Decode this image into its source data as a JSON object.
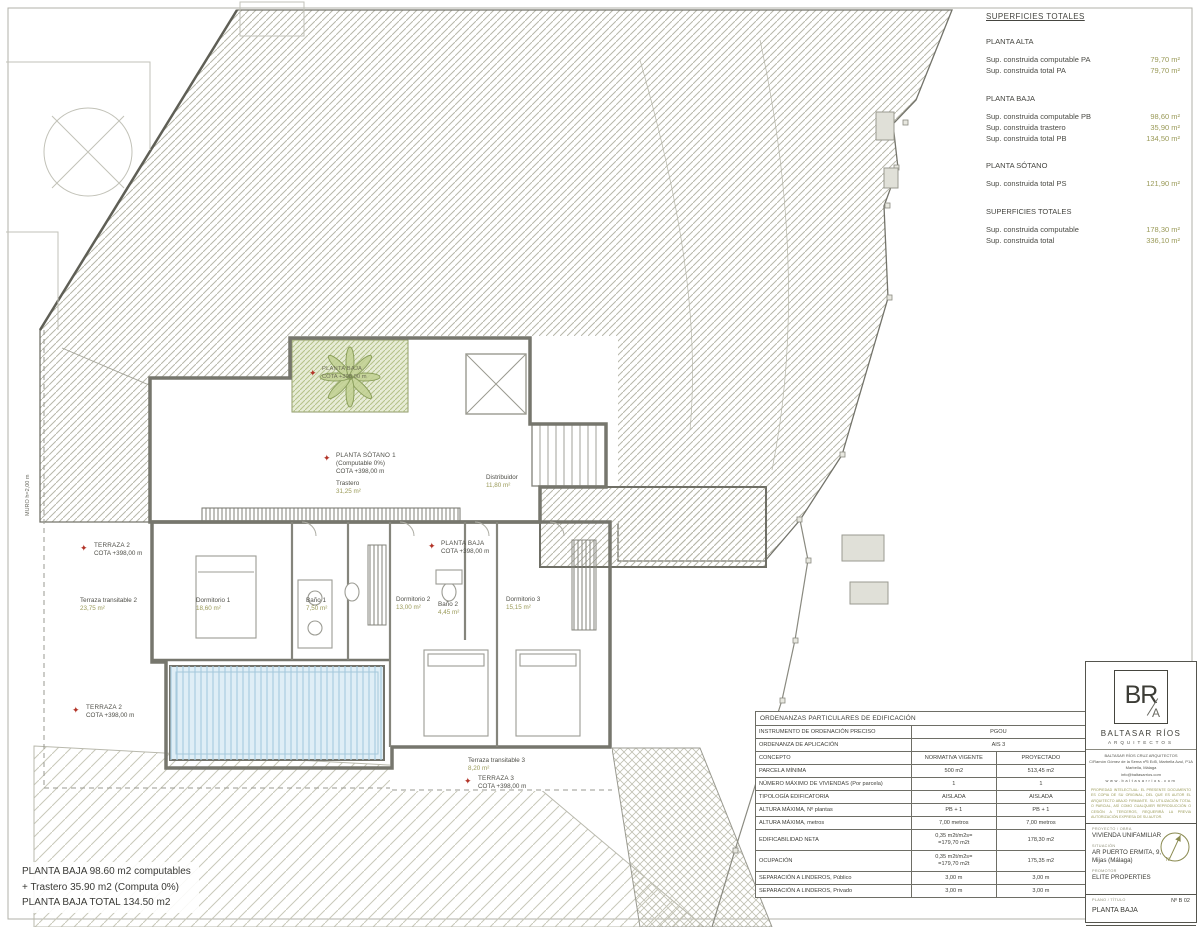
{
  "icons": {
    "star": "✦",
    "north": "N"
  },
  "superficies": {
    "title": "SUPERFICIES TOTALES",
    "sections": [
      {
        "heading": "PLANTA ALTA",
        "rows": [
          [
            "Sup. construida computable PA",
            "79,70 m²"
          ],
          [
            "Sup. construida total PA",
            "79,70 m²"
          ]
        ]
      },
      {
        "heading": "PLANTA BAJA",
        "rows": [
          [
            "Sup. construida computable PB",
            "98,60 m²"
          ],
          [
            "Sup. construida trastero",
            "35,90 m²"
          ],
          [
            "Sup. construida total PB",
            "134,50 m²"
          ]
        ]
      },
      {
        "heading": "PLANTA SÓTANO",
        "rows": [
          [
            "Sup. construida total PS",
            "121,90 m²"
          ]
        ]
      },
      {
        "heading": "SUPERFICIES TOTALES",
        "rows": [
          [
            "Sup. construida computable",
            "178,30 m²"
          ],
          [
            "Sup. construida total",
            "336,10 m²"
          ]
        ]
      }
    ]
  },
  "ordenanzas": {
    "title": "ORDENANZAS PARTICULARES DE EDIFICACIÓN",
    "instrumento_label": "INSTRUMENTO DE ORDENACIÓN PRECISO",
    "instrumento_value": "PGOU",
    "ordenanza_label": "ORDENANZA DE APLICACIÓN",
    "ordenanza_value": "AIS 3",
    "headers": [
      "CONCEPTO",
      "NORMATIVA VIGENTE",
      "PROYECTADO"
    ],
    "rows": [
      [
        "PARCELA MÍNIMA",
        "500 m2",
        "513,45 m2"
      ],
      [
        "NÚMERO MÁXIMO DE VIVIENDAS (Por parcela)",
        "1",
        "1"
      ],
      [
        "TIPOLOGÍA EDIFICATORIA",
        "AISLADA",
        "AISLADA"
      ],
      [
        "ALTURA MÁXIMA, Nº plantas",
        "PB + 1",
        "PB + 1"
      ],
      [
        "ALTURA MÁXIMA, metros",
        "7,00 metros",
        "7,00 metros"
      ],
      [
        "EDIFICABILIDAD NETA",
        "0,35 m2t/m2s=\n=179,70 m2t",
        "178,30 m2"
      ],
      [
        "OCUPACIÓN",
        "0,35 m2t/m2s=\n=179,70 m2t",
        "175,35 m2"
      ],
      [
        "SEPARACIÓN A LINDEROS, Público",
        "3,00 m",
        "3,00 m"
      ],
      [
        "SEPARACIÓN A LINDEROS, Privado",
        "3,00 m",
        "3,00 m"
      ]
    ]
  },
  "summary_note": {
    "line1": "PLANTA BAJA 98.60 m2 computables",
    "line2": "+ Trastero 35.90 m2 (Computa 0%)",
    "line3": "PLANTA BAJA TOTAL  134.50 m2"
  },
  "title_block": {
    "logo_initials": "BR",
    "logo_a": "A",
    "firm_name": "BALTASAR RÍOS",
    "firm_subtitle": "ARQUITECTOS",
    "firm_info_lines": [
      "BALTASAR RÍOS CRUZ ARQUITECTOS",
      "C/Ramón Gómez de la Serna nº5 Ed5, Marbella Azul, P1A",
      "Marbella, Málaga",
      "info@baltasarrios.com",
      "www.baltasarrios.com"
    ],
    "disclaimer": "PROPIEDAD INTELECTUAL: EL PRESENTE DOCUMENTO ES COPIA DE SU ORIGINAL, DEL QUE ES AUTOR EL ARQUITECTO ABAJO FIRMANTE. SU UTILIZACIÓN TOTAL O PARCIAL, ASÍ COMO CUALQUIER REPRODUCCIÓN O CESIÓN A TERCEROS, REQUERIRÁ LA PREVIA AUTORIZACIÓN EXPRESA DE SU AUTOR.",
    "proyecto_label": "PROYECTO / OBRA",
    "proyecto_value": "VIVIENDA UNIFAMILIAR",
    "situacion_label": "SITUACIÓN",
    "situacion_value": "AR PUERTO ERMITA, 9,\nMijas (Málaga)",
    "promotor_label": "PROMOTOR",
    "promotor_value": "ELITE PROPERTIES",
    "plano_label": "PLANO / TÍTULO",
    "plano_number": "Nº B 02",
    "plano_title": "PLANTA BAJA",
    "fecha_label": "FECHA",
    "fecha_value": "16.06.2023",
    "revision_label": "REVISIÓN",
    "escala_label": "ESCALA",
    "escala_line1": "A1 1/50",
    "escala_line2": "A3 1/100"
  },
  "plan": {
    "muro_label": "MURO h=2,00 m",
    "labels": {
      "planta_sotano": {
        "title": "PLANTA SÓTANO 1",
        "sub1": "(Computable 0%)",
        "sub2": "COTA +398,00 m",
        "room": "Trastero",
        "area": "31,25 m²"
      },
      "distribuidor": {
        "room": "Distribuidor",
        "area": "11,80 m²"
      },
      "planta_baja": {
        "title": "PLANTA BAJA",
        "sub": "COTA +398,00 m"
      },
      "planta_baja_planter": {
        "title": "PLANTA BAJA",
        "sub": "COTA +398,00 m"
      },
      "terraza2_top": {
        "title": "TERRAZA 2",
        "sub": "COTA +398,00 m"
      },
      "terraza2_bottom": {
        "title": "TERRAZA 2",
        "sub": "COTA +398,00 m"
      },
      "terraza3": {
        "title": "TERRAZA 3",
        "sub": "COTA +398,00 m"
      },
      "terraza_transitable2": {
        "room": "Terraza transitable 2",
        "area": "23,75 m²"
      },
      "terraza_transitable3": {
        "room": "Terraza transitable 3",
        "area": "8,20 m²"
      },
      "dormitorio1": {
        "room": "Dormitorio 1",
        "area": "18,60 m²"
      },
      "bano1": {
        "room": "Baño 1",
        "area": "7,50 m²"
      },
      "dormitorio2": {
        "room": "Dormitorio 2",
        "area": "13,00 m²"
      },
      "bano2": {
        "room": "Baño 2",
        "area": "4,45 m²"
      },
      "dormitorio3": {
        "room": "Dormitorio 3",
        "area": "15,15 m²"
      }
    }
  }
}
